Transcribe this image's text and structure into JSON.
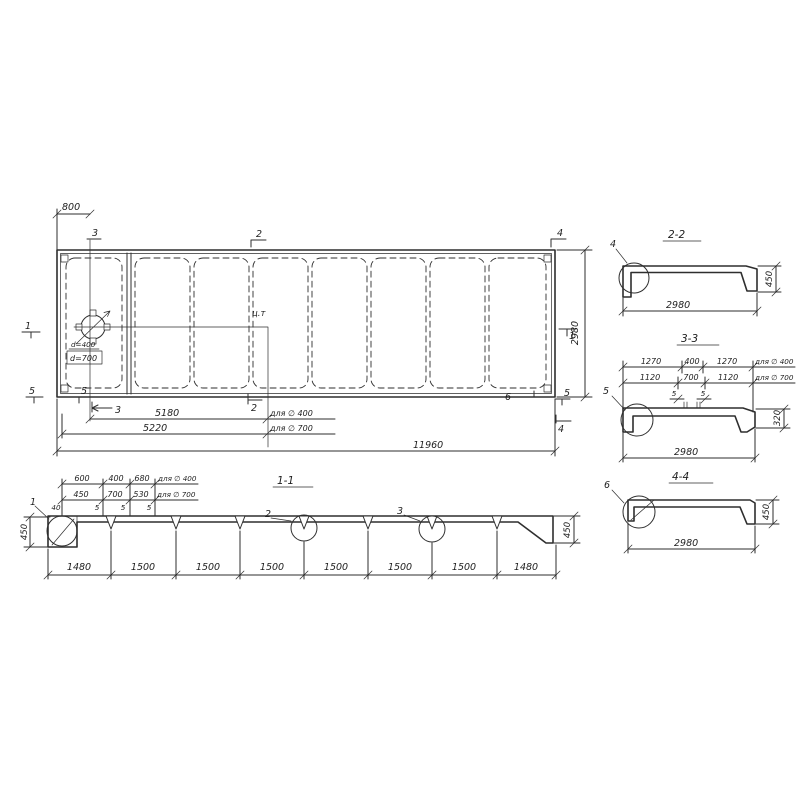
{
  "plan": {
    "dim_800": "800",
    "dim_2980": "2980",
    "dim_5180": "5180",
    "dim_5220": "5220",
    "dim_11960": "11960",
    "note_d400": "для ∅ 400",
    "note_d700": "для ∅ 700",
    "center_of_gravity": "ц.т",
    "hole_d400": "d=400",
    "hole_d700": "d=700",
    "mark_1": "1",
    "mark_2": "2",
    "mark_3": "3",
    "mark_4": "4",
    "mark_5": "5",
    "mark_6": "6"
  },
  "sec22": {
    "title": "2-2",
    "detail": "4",
    "dim_width": "2980",
    "dim_height": "450"
  },
  "sec33": {
    "title": "3-3",
    "detail": "5",
    "r1": [
      "1270",
      "400",
      "1270"
    ],
    "r1_note": "для ∅ 400",
    "r2": [
      "1120",
      "700",
      "1120"
    ],
    "r2_note": "для ∅ 700",
    "gap": "5",
    "dim_width": "2980",
    "dim_height": "320"
  },
  "sec44": {
    "title": "4-4",
    "detail": "6",
    "dim_width": "2980",
    "dim_height": "450"
  },
  "sec11": {
    "title": "1-1",
    "detail_1": "1",
    "detail_2": "2",
    "detail_3": "3",
    "rowA": [
      "600",
      "400",
      "680"
    ],
    "rowA_note": "для ∅ 400",
    "rowB": [
      "450",
      "700",
      "530"
    ],
    "rowB_note": "для ∅ 700",
    "rowC": [
      "40",
      "5",
      "5",
      "5"
    ],
    "dim_height_left": "450",
    "dim_height_right": "450",
    "bottom_dims": [
      "1480",
      "1500",
      "1500",
      "1500",
      "1500",
      "1500",
      "1500",
      "1480"
    ]
  }
}
